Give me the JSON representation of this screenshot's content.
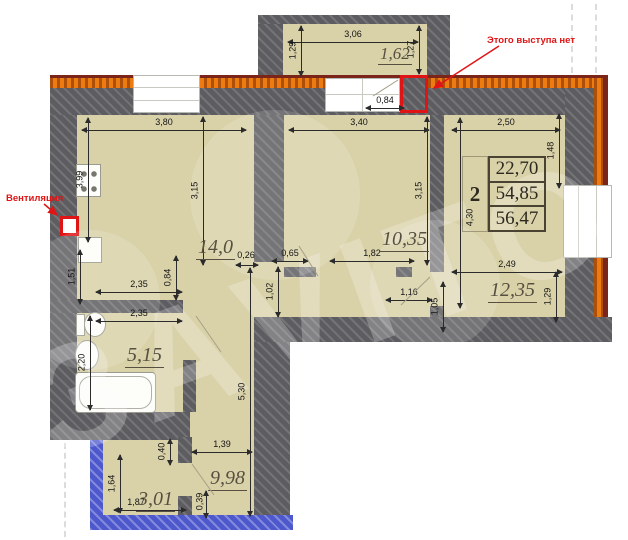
{
  "watermark": "ЗАVITO",
  "annotations": {
    "ventilation": "Вентиляция",
    "no_protrusion": "Этого выступа нет"
  },
  "summary_table": {
    "rooms_count": "2",
    "areas": [
      "22,70",
      "54,85",
      "56,47"
    ]
  },
  "room_labels": [
    {
      "text": "1,62",
      "x": 378,
      "y": 44,
      "size": 17
    },
    {
      "text": "14,0",
      "x": 196,
      "y": 236,
      "size": 20
    },
    {
      "text": "10,35",
      "x": 380,
      "y": 228,
      "size": 20
    },
    {
      "text": "12,35",
      "x": 488,
      "y": 279,
      "size": 20
    },
    {
      "text": "5,15",
      "x": 125,
      "y": 344,
      "size": 20
    },
    {
      "text": "9,98",
      "x": 208,
      "y": 467,
      "size": 20
    },
    {
      "text": "3,01",
      "x": 136,
      "y": 488,
      "size": 20
    }
  ],
  "dimensions": [
    {
      "text": "3,06",
      "o": "h",
      "x": 288,
      "y": 42,
      "len": 130
    },
    {
      "text": "1,29",
      "o": "v",
      "x": 301,
      "y": 26,
      "len": 50
    },
    {
      "text": "1,27",
      "o": "v",
      "x": 419,
      "y": 26,
      "len": 48
    },
    {
      "text": "0,84",
      "o": "h",
      "x": 366,
      "y": 108,
      "len": 38
    },
    {
      "text": "3,80",
      "o": "h",
      "x": 82,
      "y": 130,
      "len": 164
    },
    {
      "text": "3,15",
      "o": "v",
      "x": 203,
      "y": 117,
      "len": 148
    },
    {
      "text": "3,40",
      "o": "h",
      "x": 289,
      "y": 130,
      "len": 140
    },
    {
      "text": "3,15",
      "o": "v",
      "x": 427,
      "y": 117,
      "len": 148
    },
    {
      "text": "2,50",
      "o": "h",
      "x": 452,
      "y": 130,
      "len": 108
    },
    {
      "text": "1,48",
      "o": "v",
      "x": 559,
      "y": 114,
      "len": 74
    },
    {
      "text": "4,30",
      "o": "v",
      "x": 460,
      "y": 118,
      "len": 190,
      "lx": 452,
      "ly": 212
    },
    {
      "text": "3,99",
      "o": "v",
      "x": 88,
      "y": 118,
      "len": 124
    },
    {
      "text": "1,51",
      "o": "v",
      "x": 80,
      "y": 250,
      "len": 54
    },
    {
      "text": "2,35",
      "o": "h",
      "x": 96,
      "y": 292,
      "len": 86
    },
    {
      "text": "0,84",
      "o": "v",
      "x": 176,
      "y": 256,
      "len": 44
    },
    {
      "text": "0,26",
      "o": "h",
      "x": 236,
      "y": 265,
      "len": 22,
      "lx": 228,
      "ly": 250
    },
    {
      "text": "0,65",
      "o": "h",
      "x": 272,
      "y": 261,
      "len": 36
    },
    {
      "text": "1,82",
      "o": "h",
      "x": 330,
      "y": 261,
      "len": 84
    },
    {
      "text": "2,35",
      "o": "h",
      "x": 96,
      "y": 321,
      "len": 86
    },
    {
      "text": "2,20",
      "o": "v",
      "x": 90,
      "y": 316,
      "len": 94
    },
    {
      "text": "1,02",
      "o": "v",
      "x": 278,
      "y": 267,
      "len": 50
    },
    {
      "text": "1,16",
      "o": "h",
      "x": 386,
      "y": 300,
      "len": 46
    },
    {
      "text": "1,05",
      "o": "v",
      "x": 443,
      "y": 282,
      "len": 50
    },
    {
      "text": "2,49",
      "o": "h",
      "x": 452,
      "y": 272,
      "len": 110
    },
    {
      "text": "1,29",
      "o": "v",
      "x": 556,
      "y": 272,
      "len": 50
    },
    {
      "text": "5,30",
      "o": "v",
      "x": 250,
      "y": 268,
      "len": 248
    },
    {
      "text": "1,39",
      "o": "h",
      "x": 192,
      "y": 452,
      "len": 60
    },
    {
      "text": "0,40",
      "o": "v",
      "x": 170,
      "y": 439,
      "len": 26
    },
    {
      "text": "1,64",
      "o": "v",
      "x": 120,
      "y": 455,
      "len": 58
    },
    {
      "text": "1,87",
      "o": "h",
      "x": 114,
      "y": 510,
      "len": 72,
      "lx": 118,
      "ly": 497
    },
    {
      "text": "0,39",
      "o": "v",
      "x": 206,
      "y": 491,
      "len": 27,
      "lx": 182,
      "ly": 496
    }
  ],
  "colors": {
    "room_fill": "#d9d2a9",
    "wall_gray": "#5d5d61",
    "exterior_orange": "#ec7c12",
    "exterior_dark_red": "#7a241a",
    "balcony_blue": "#4d58cd",
    "highlight_red": "#e01414"
  }
}
